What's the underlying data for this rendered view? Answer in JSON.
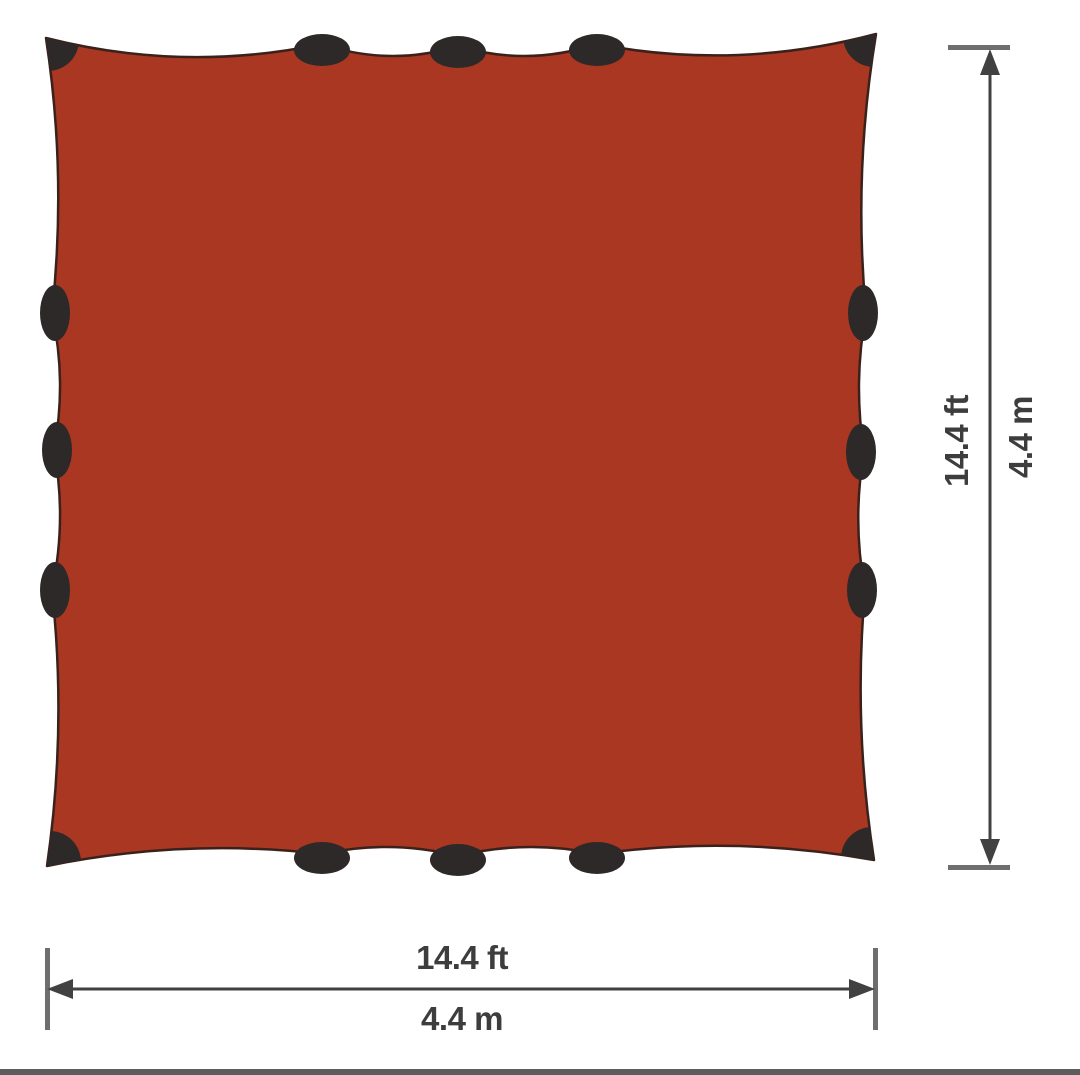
{
  "diagram": {
    "subject": "square-tarp-top-view-dimension-diagram",
    "tarp": {
      "fill_color": "#a93721",
      "outline_color": "#3a211b",
      "attachment_color": "#2d2928",
      "attachment_tabs_per_side": 3,
      "corner_patches": 4
    },
    "height_dimension": {
      "ft": "14.4 ft",
      "m": "4.4 m"
    },
    "width_dimension": {
      "ft": "14.4 ft",
      "m": "4.4 m"
    },
    "annotation": {
      "line_color": "#414141",
      "cap_color": "#6e6e6e",
      "text_color": "#3d3d3d"
    }
  },
  "page": {
    "background_color": "#ffffff",
    "bottom_divider_color": "#5c5c5c"
  }
}
